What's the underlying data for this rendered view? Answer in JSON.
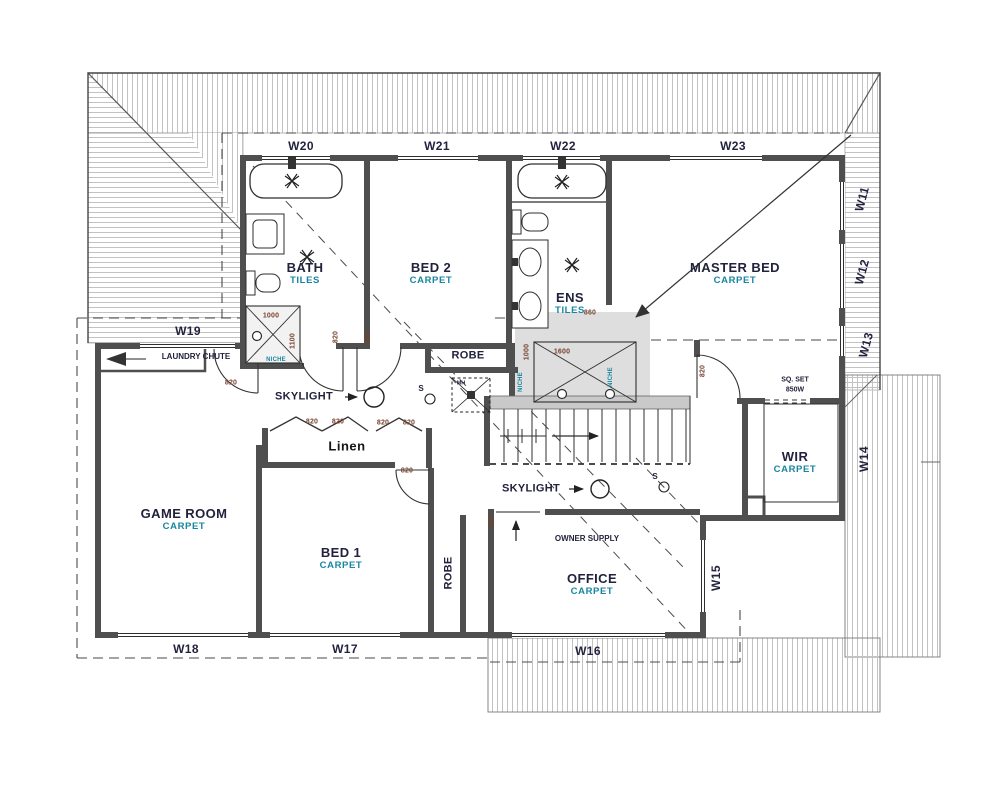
{
  "colors": {
    "room_name": "#22223d",
    "finish": "#1786a0",
    "window_label": "#23233f",
    "dimension": "#76412f",
    "annotation": "#22223d",
    "linen": "#151515"
  },
  "windows": {
    "w11": "W11",
    "w12": "W12",
    "w13": "W13",
    "w14": "W14",
    "w15": "W15",
    "w16": "W16",
    "w17": "W17",
    "w18": "W18",
    "w19": "W19",
    "w20": "W20",
    "w21": "W21",
    "w22": "W22",
    "w23": "W23"
  },
  "rooms": {
    "bath": {
      "name": "BATH",
      "finish": "TILES"
    },
    "bed2": {
      "name": "BED 2",
      "finish": "CARPET"
    },
    "ens": {
      "name": "ENS",
      "finish": "TILES"
    },
    "master": {
      "name": "MASTER BED",
      "finish": "CARPET"
    },
    "game": {
      "name": "GAME ROOM",
      "finish": "CARPET"
    },
    "bed1": {
      "name": "BED 1",
      "finish": "CARPET"
    },
    "office": {
      "name": "OFFICE",
      "finish": "CARPET"
    },
    "wir": {
      "name": "WIR",
      "finish": "CARPET"
    }
  },
  "closets": {
    "linen": "Linen",
    "robe_bed2": "ROBE",
    "robe_bed1": "ROBE"
  },
  "annotations": {
    "laundry_chute": "LAUNDRY CHUTE",
    "skylight_upper": "SKYLIGHT",
    "skylight_lower": "SKYLIGHT",
    "owner_supply": "OWNER SUPPLY",
    "sq_set_line1": "SQ. SET",
    "sq_set_line2": "850W",
    "manhole": "MH",
    "smoke_upper": "S",
    "smoke_lower": "S"
  },
  "dimensions": {
    "bath_shower_width": "1000",
    "bath_shower_depth": "1100",
    "bath_niche": "NICHE",
    "bath_door": "820",
    "bed2_door": "820",
    "game_door": "820",
    "linen_door_l1": "820",
    "linen_door_l2": "820",
    "linen_door_r1": "820",
    "linen_door_r2": "820",
    "bed1_door": "820",
    "master_door": "820",
    "ens_opening": "860",
    "ens_shower_width": "1600",
    "ens_shower_depth": "1000",
    "ens_niche_left": "NICHE",
    "ens_niche_right": "NICHE",
    "office_opening": "800"
  }
}
